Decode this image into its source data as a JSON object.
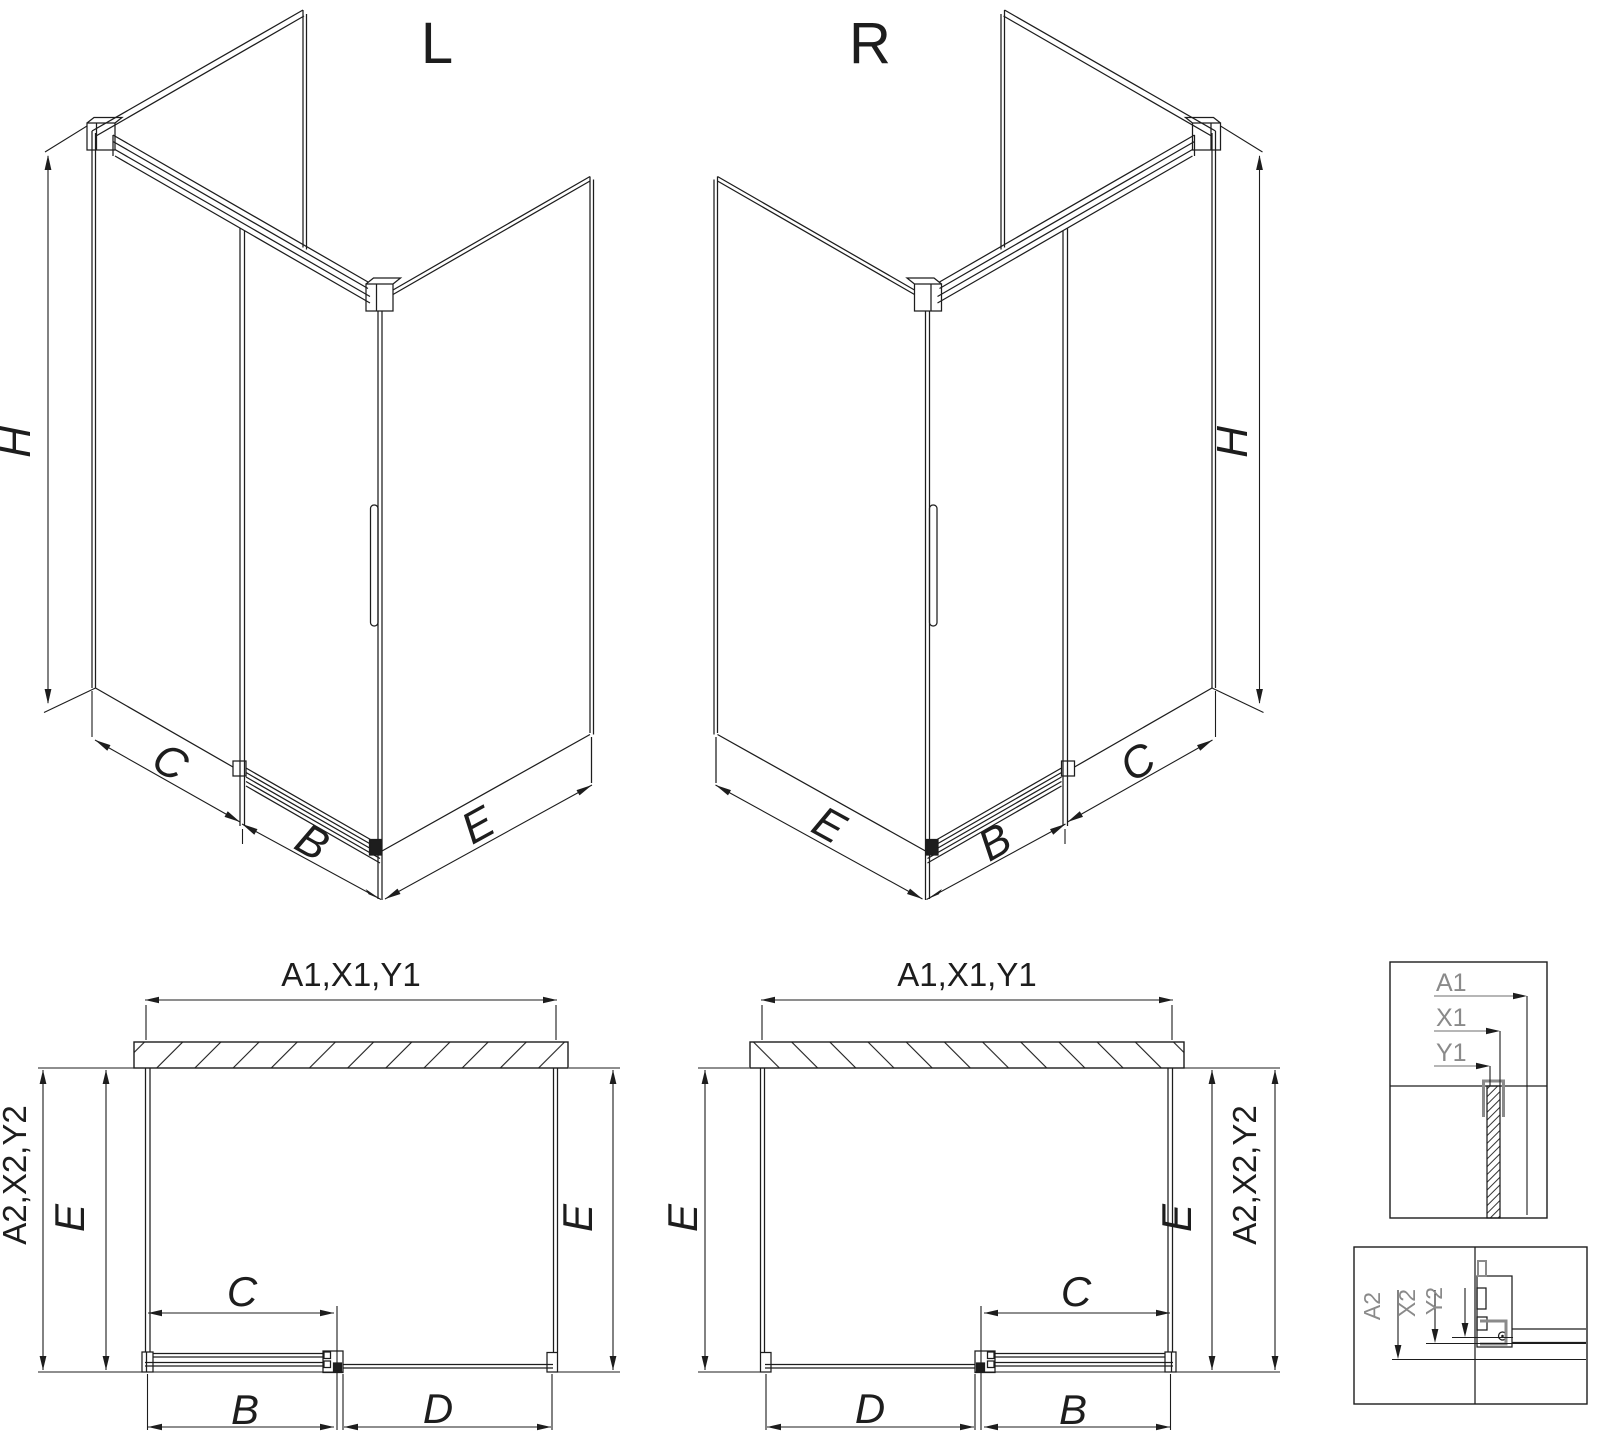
{
  "diagram": {
    "iso_left": {
      "title": "L",
      "height": "H",
      "panel_c": "C",
      "door_b": "B",
      "panel_e": "E"
    },
    "iso_right": {
      "title": "R",
      "height": "H",
      "panel_c": "C",
      "door_b": "B",
      "panel_e": "E"
    },
    "plan_left": {
      "width_top": "A1,X1,Y1",
      "depth_side": "A2,X2,Y2",
      "e_left": "E",
      "e_right": "E",
      "c": "C",
      "b": "B",
      "d": "D"
    },
    "plan_right": {
      "width_top": "A1,X1,Y1",
      "depth_side": "A2,X2,Y2",
      "e_left": "E",
      "e_right": "E",
      "c": "C",
      "b": "B",
      "d": "D"
    },
    "detail_top": {
      "a1": "A1",
      "x1": "X1",
      "y1": "Y1"
    },
    "detail_bottom": {
      "a2": "A2",
      "x2": "X2",
      "y2": "Y2"
    }
  },
  "colors": {
    "line": "#1d1d1d",
    "gray": "#8a8a8a",
    "background": "#ffffff"
  }
}
